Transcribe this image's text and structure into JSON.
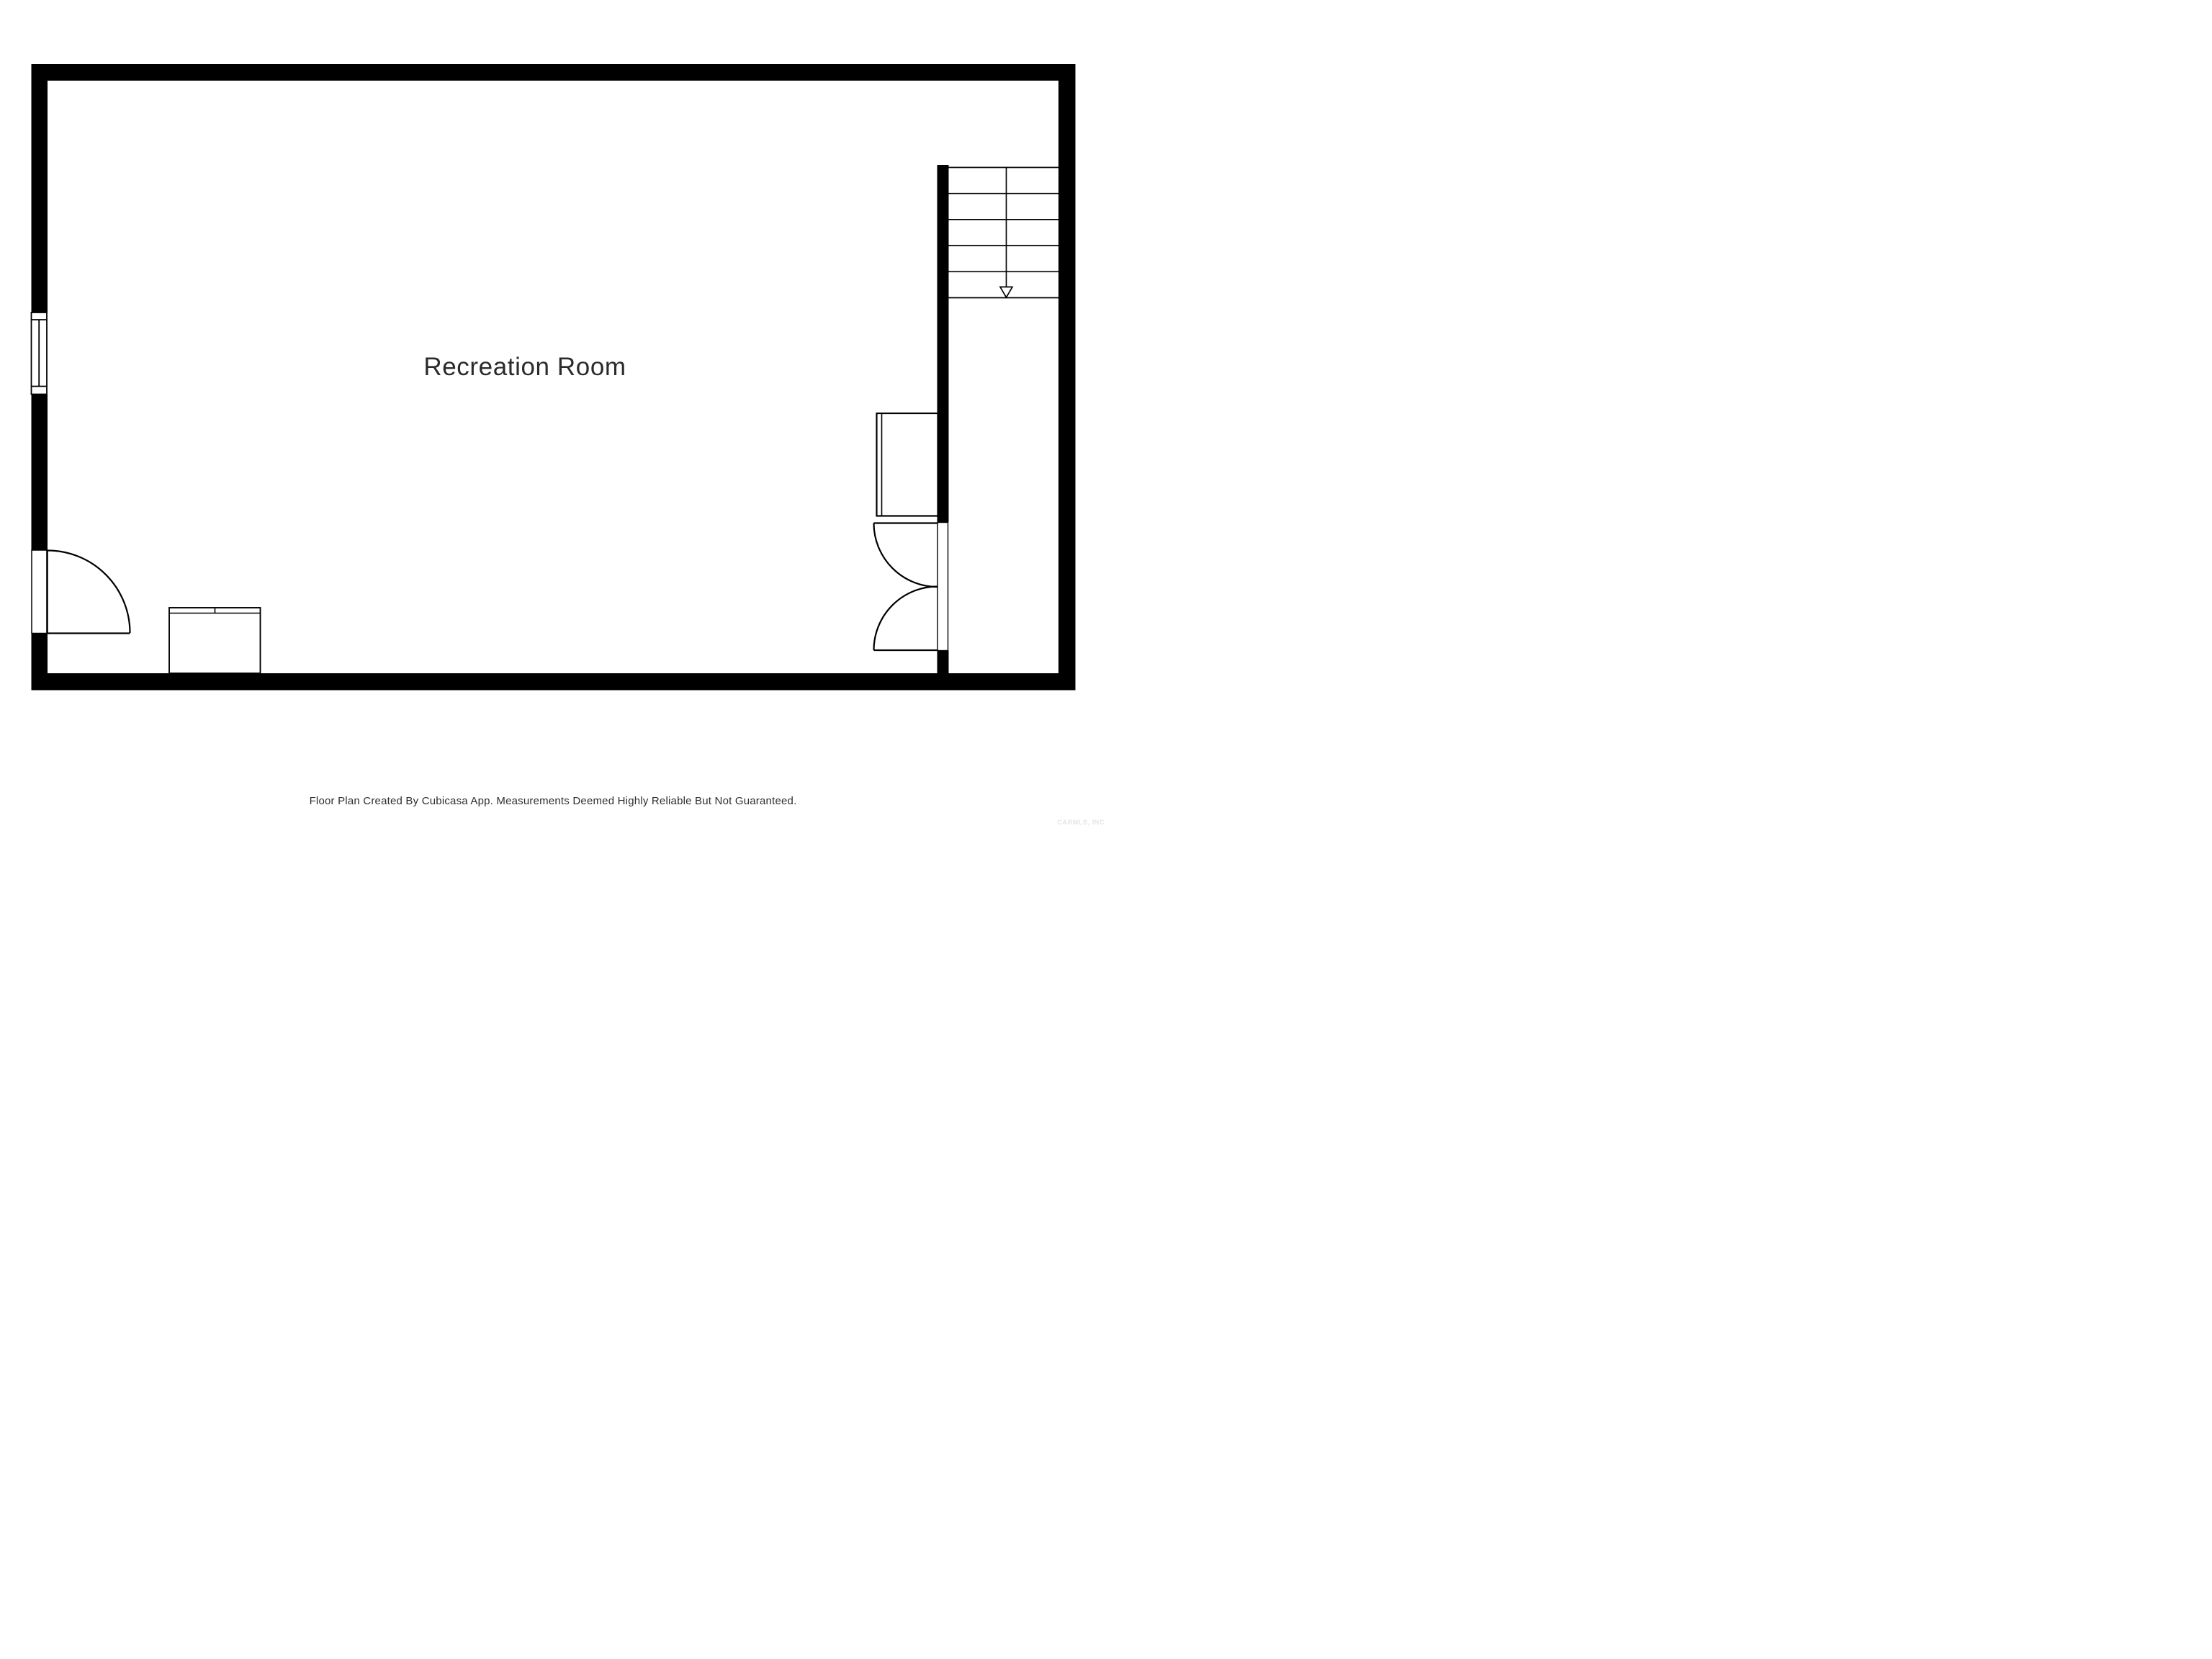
{
  "plan": {
    "room_label": "Recreation Room",
    "footer_text": "Floor Plan Created By Cubicasa App. Measurements Deemed Highly Reliable But Not Guaranteed.",
    "watermark_text": "CARMLS, INC",
    "colors": {
      "background": "#ffffff",
      "wall": "#000000",
      "label": "#2b2b2b",
      "footer": "#2e2e2e",
      "watermark": "#e4e4e4"
    },
    "symbols": {
      "staircase": {
        "treads": 5,
        "direction_arrow": "down"
      },
      "window_count": 1,
      "swing_door_count": 3,
      "cabinet_count": 1,
      "console_count": 1
    }
  }
}
